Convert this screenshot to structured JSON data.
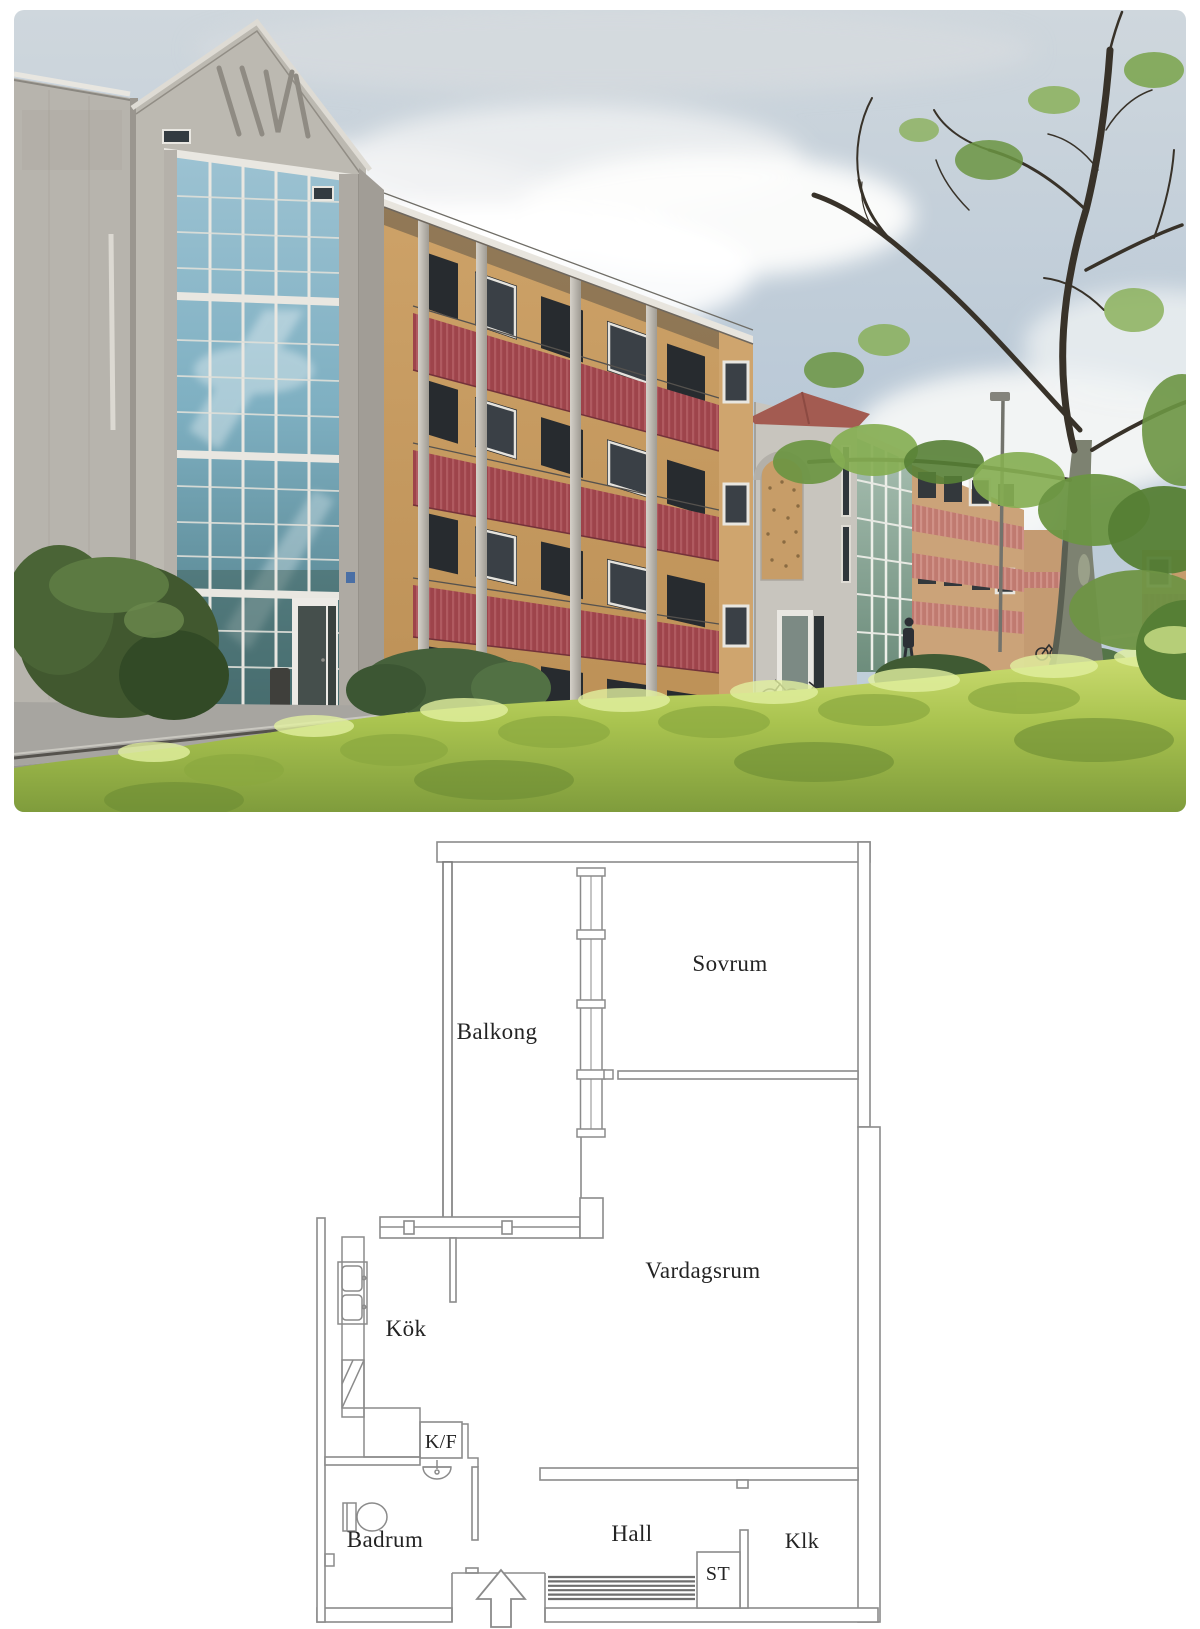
{
  "photo": {
    "alt": "Four-storey apartment buildings: yellow brick facades with dark-red corrugated balcony fronts and round concrete pillars, a tall concrete section with glazed curtain wall and triangular pediment, an entrance tower with arched brick inlay and small red roof, green hedges in the foreground and a large tree to the right under a cloudy blue sky",
    "colors": {
      "sky_top": "#cfd7dd",
      "sky_bottom": "#b9c9d8",
      "cloud": "#fbfbfa",
      "concrete": "#bcb9b1",
      "concrete_dark": "#a39f98",
      "glass_light": "#9cc2d2",
      "glass_dark": "#5d8a96",
      "mullion": "#e9e7e1",
      "brick": "#c5995f",
      "brick_light": "#cfa56e",
      "balcony_red": "#9e444b",
      "balcony_red_rib": "#b05a60",
      "salmon": "#c07a70",
      "roof_red": "#a35b51",
      "hedge_bright": "#b8cc5a",
      "hedge_sunlit": "#dff095",
      "hedge_shadow": "#6d8c33",
      "bush_dark": "#41582f",
      "asphalt": "#96948e",
      "tree_branch": "#383229",
      "tree_leaf": "#86ae52",
      "trunk": "#7d8271"
    }
  },
  "plan": {
    "wall_color": "#8b8b8b",
    "text_color": "#232323",
    "background": "#ffffff",
    "rooms": [
      {
        "id": "balkong",
        "label": "Balkong"
      },
      {
        "id": "sovrum",
        "label": "Sovrum"
      },
      {
        "id": "vardagsrum",
        "label": "Vardagsrum"
      },
      {
        "id": "kok",
        "label": "Kök"
      },
      {
        "id": "kf",
        "label": "K/F"
      },
      {
        "id": "badrum",
        "label": "Badrum"
      },
      {
        "id": "hall",
        "label": "Hall"
      },
      {
        "id": "st",
        "label": "ST"
      },
      {
        "id": "klk",
        "label": "Klk"
      }
    ],
    "fixtures": [
      {
        "name": "kitchen-sink"
      },
      {
        "name": "dishwasher"
      },
      {
        "name": "fridge-freezer"
      },
      {
        "name": "washbasin"
      },
      {
        "name": "toilet"
      },
      {
        "name": "doormat"
      },
      {
        "name": "entrance-arrow"
      },
      {
        "name": "window-markers"
      },
      {
        "name": "glazed-balcony-wall"
      }
    ]
  }
}
